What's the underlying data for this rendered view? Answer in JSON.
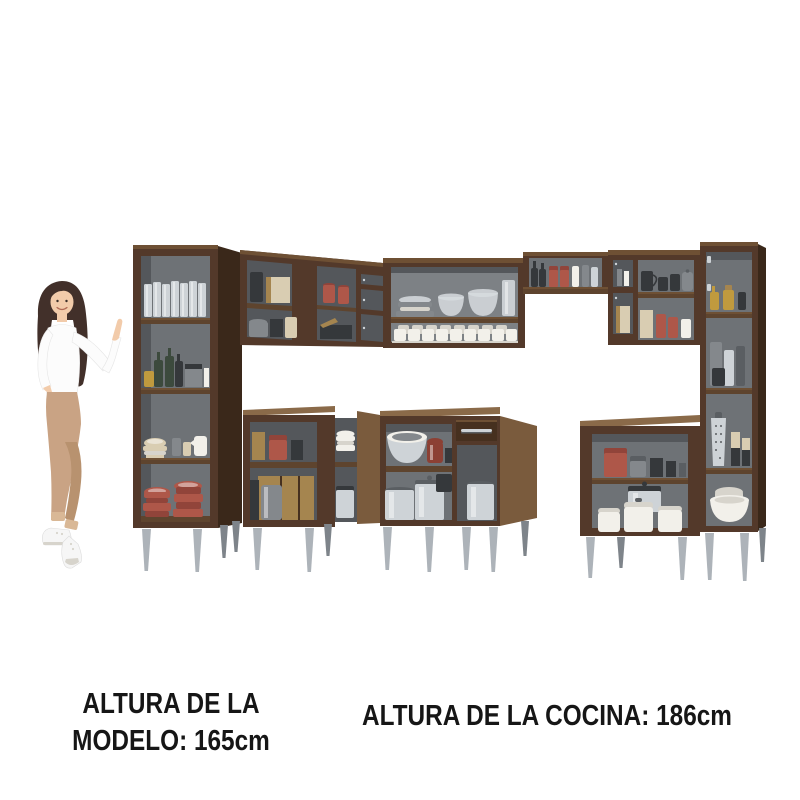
{
  "page": {
    "width_px": 800,
    "height_px": 800,
    "background": "#ffffff"
  },
  "captions": {
    "model": {
      "line1": "ALTURA DE LA",
      "line2": "MODELO: 165cm"
    },
    "kitchen": {
      "text": "ALTURA DE LA COCINA: 186cm"
    }
  },
  "figures": {
    "model": "woman-model-pointing-at-kitchen-set",
    "kitchen": "l-shaped-corner-kitchen-cabinet-set-open-shelves"
  },
  "palette": {
    "background": "#ffffff",
    "text": "#161616",
    "wood_front": "#53392a",
    "wood_front_dark": "#46301f",
    "wood_side_light": "#7a5b3d",
    "wood_side_dark": "#3a281a",
    "wood_top": "#6e5034",
    "counter_top": "#8a6a49",
    "shelf_edge": "#5e442e",
    "interior_back": "#6e7276",
    "interior_back_dark": "#54575b",
    "interior_back_light": "#7d8185",
    "leg_silver": "#adb3b9",
    "leg_dark": "#7e848a",
    "steel": "#ced3d7",
    "steel_dark": "#5a5e62",
    "red_ceramic": "#ae5749",
    "red_ceramic_dark": "#91443a",
    "copper": "#8c4034",
    "cream": "#d9cdb2",
    "board_tan": "#a5854f",
    "gold": "#c09a3e",
    "bottle_green": "#3c4a3d",
    "gray_item": "#84888c",
    "dark_item": "#35383b",
    "white_dish": "#f2f0ea",
    "white_dish_shadow": "#d7d4cc",
    "glass": "#d7dcdf",
    "skin": "#f2cbaa",
    "hair": "#42302a",
    "shirt": "#fcfcfc",
    "pants": "#c9a384",
    "pants_dark": "#b8926f",
    "pants_light": "#d9b896",
    "shoe": "#f6f6f6"
  }
}
